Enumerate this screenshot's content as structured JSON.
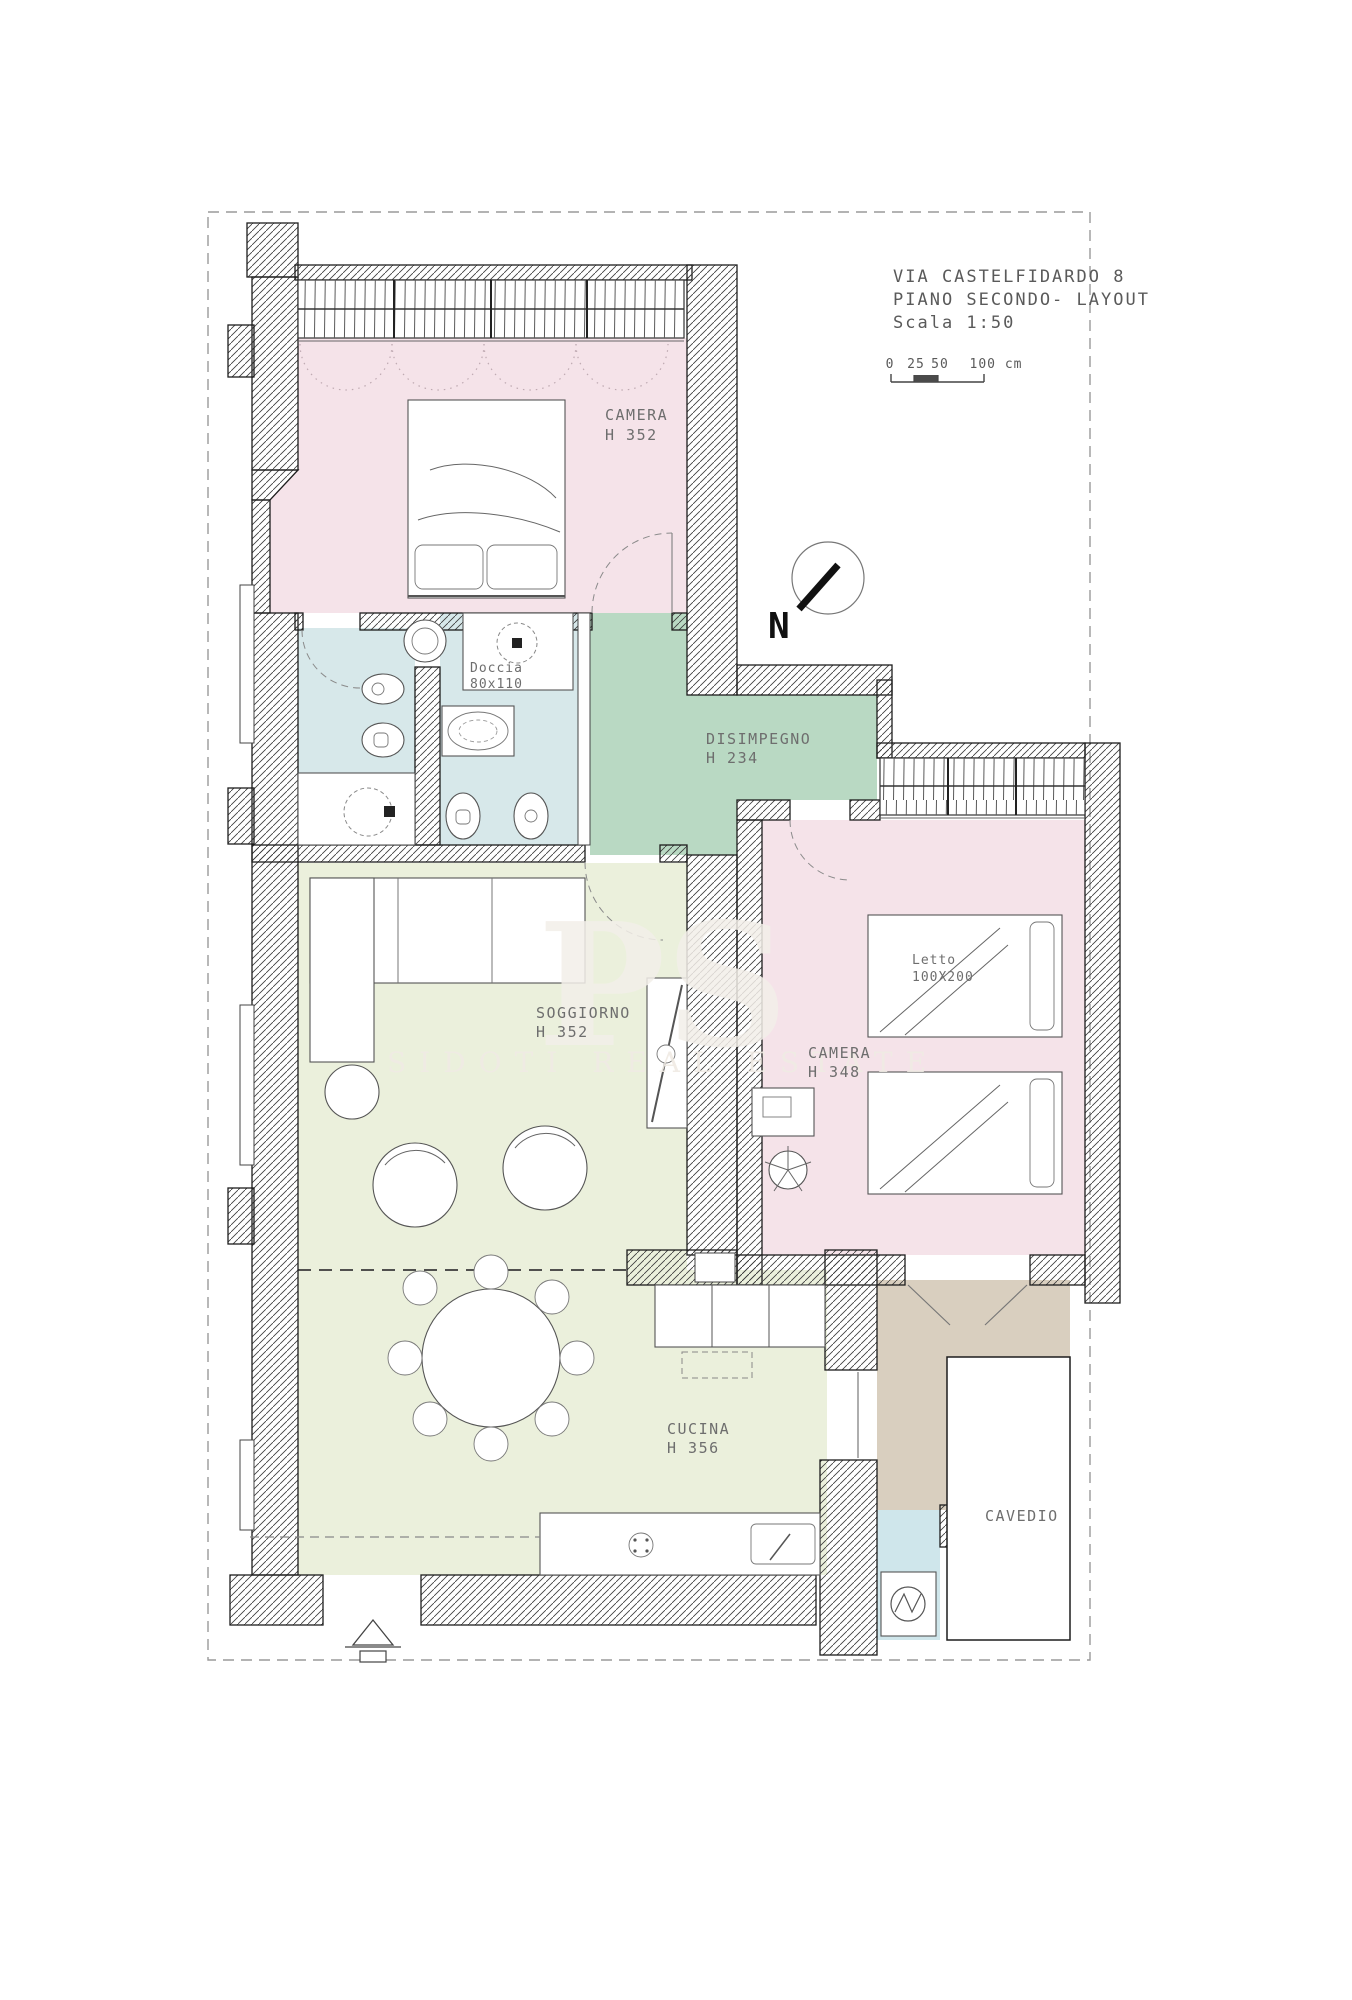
{
  "title_block": {
    "line1": "VIA CASTELFIDARDO 8",
    "line2": "PIANO SECONDO- LAYOUT",
    "line3": "Scala 1:50"
  },
  "scale_bar": {
    "tick0": "0",
    "tick25": "25",
    "tick50": "50",
    "tick100": "100 cm"
  },
  "compass": {
    "north_label": "N"
  },
  "watermark": {
    "monogram": "PS",
    "brand": "SIDOTI REAL ESTATE"
  },
  "rooms": {
    "camera1": {
      "label": "CAMERA",
      "height": "H 352",
      "color": "#f5e3e9"
    },
    "bagno1": {
      "color": "#d7e8ea"
    },
    "bagno2": {
      "color": "#d7e8ea"
    },
    "doccia": {
      "label": "Doccia",
      "size": "80x110"
    },
    "disimpegno": {
      "label": "DISIMPEGNO",
      "height": "H 234",
      "color": "#b9d9c3"
    },
    "soggiorno": {
      "label": "SOGGIORNO",
      "height": "H 352",
      "color": "#ebf0dc"
    },
    "camera2": {
      "label": "CAMERA",
      "height": "H 348",
      "color": "#f5e3e9"
    },
    "letto": {
      "label": "Letto",
      "size": "100X200"
    },
    "cucina": {
      "label": "CUCINA",
      "height": "H 356",
      "color": "#ebf0dc"
    },
    "balcone": {
      "color": "#d9cfbf"
    },
    "lavanderia": {
      "color": "#cfe6eb"
    },
    "cavedio": {
      "label": "CAVEDIO"
    }
  }
}
